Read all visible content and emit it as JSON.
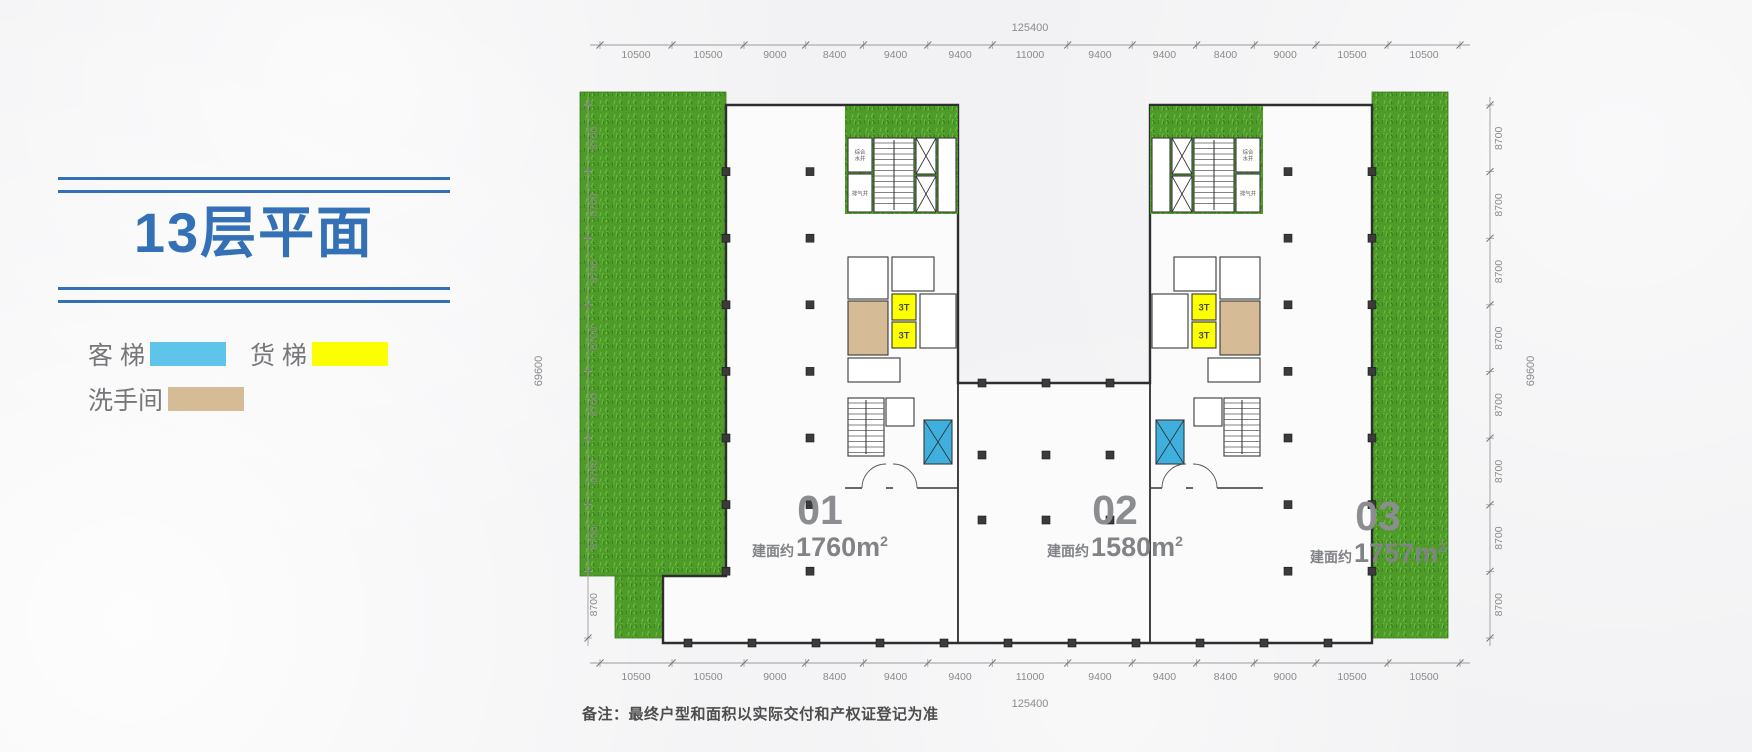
{
  "title": {
    "text": "13层平面"
  },
  "legend": {
    "items": [
      {
        "name": "passenger-elevator",
        "label": "客 梯",
        "color": "#5ec4e9"
      },
      {
        "name": "freight-elevator",
        "label": "货 梯",
        "color": "#fcff00"
      },
      {
        "name": "restroom",
        "label": "洗手间",
        "color": "#d6bb97"
      }
    ]
  },
  "dims": {
    "top": [
      10500,
      10500,
      9000,
      8400,
      9400,
      9400,
      11000,
      9400,
      9400,
      8400,
      9000,
      10500,
      10500
    ],
    "bottom": [
      10500,
      10500,
      9000,
      8400,
      9400,
      9400,
      11000,
      9400,
      9400,
      8400,
      9000,
      10500,
      10500
    ],
    "left": [
      8700,
      8700,
      8700,
      8700,
      8700,
      8700,
      8700,
      8700
    ],
    "right": [
      8700,
      8700,
      8700,
      8700,
      8700,
      8700,
      8700,
      8700
    ],
    "total_width": "125400",
    "total_height": "69600"
  },
  "units": [
    {
      "id": "01",
      "prefix": "建面约",
      "value": "1760",
      "unit": "m",
      "sup": "2"
    },
    {
      "id": "02",
      "prefix": "建面约",
      "value": "1580",
      "unit": "m",
      "sup": "2"
    },
    {
      "id": "03",
      "prefix": "建面约",
      "value": "1757",
      "unit": "m",
      "sup": "2"
    }
  ],
  "core": {
    "water_shaft": "综合水井",
    "vent_shaft": "排气井",
    "freight_label": "3T"
  },
  "note": "备注：最终户型和面积以实际交付和产权证登记为准",
  "colors": {
    "accent_blue": "#3470b6",
    "passenger_blue": "#3fb0dd",
    "freight_yellow": "#fcff00",
    "restroom_tan": "#d6bb97",
    "grass_green": "#4e9b29"
  }
}
